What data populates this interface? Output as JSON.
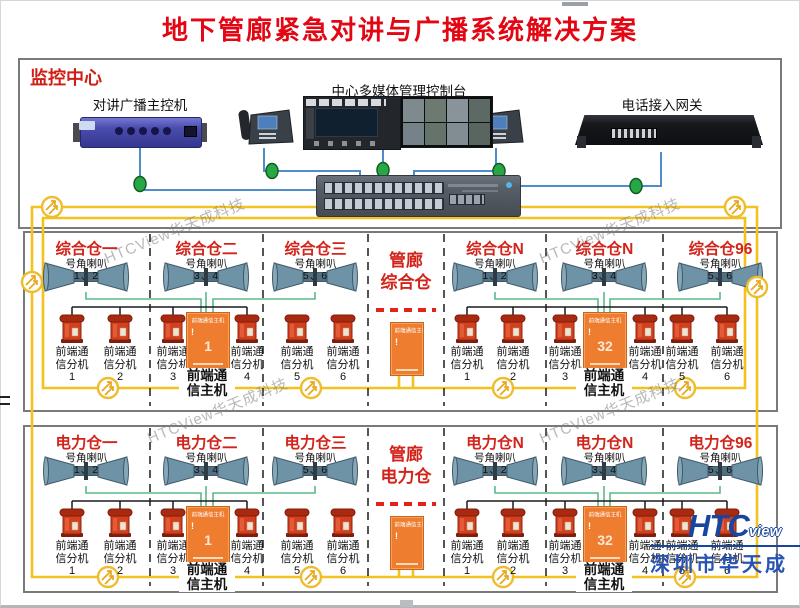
{
  "title": "地下管廊紧急对讲与广播系统解决方案",
  "monitoring": {
    "label": "监控中心",
    "main_controller": "对讲广播主控机",
    "console": "中心多媒体管理控制台",
    "gateway": "电话接入网关"
  },
  "shared": {
    "speaker_label": "号角喇叭",
    "phone_caption_l1": "前端通",
    "phone_caption_l2": "信分机",
    "host_caption_l1": "前端通",
    "host_caption_l2": "信主机",
    "host_tiny": "前端通信主机",
    "alert_mark": "!"
  },
  "sections": [
    {
      "compartments": [
        {
          "title": "综合仓一",
          "speakers": "1、2",
          "phones": [
            "1",
            "2"
          ]
        },
        {
          "title": "综合仓二",
          "speakers": "3、4",
          "phones": [
            "3",
            "4"
          ],
          "host_number": "1"
        },
        {
          "title": "综合仓三",
          "speakers": "5、6",
          "phones": [
            "5",
            "6"
          ]
        },
        {
          "title_line1": "管廊",
          "title_line2": "综合仓"
        },
        {
          "title": "综合仓N",
          "speakers": "1、2",
          "phones": [
            "1",
            "2"
          ]
        },
        {
          "title": "综合仓N",
          "speakers": "3、4",
          "phones": [
            "3",
            "4"
          ],
          "host_number": "32"
        },
        {
          "title": "综合仓96",
          "speakers": "5、6",
          "phones": [
            "5",
            "6"
          ]
        }
      ]
    },
    {
      "compartments": [
        {
          "title": "电力仓一",
          "speakers": "1、2",
          "phones": [
            "1",
            "2"
          ]
        },
        {
          "title": "电力仓二",
          "speakers": "3、4",
          "phones": [
            "3",
            "4"
          ],
          "host_number": "1"
        },
        {
          "title": "电力仓三",
          "speakers": "5、6",
          "phones": [
            "5",
            "6"
          ]
        },
        {
          "title_line1": "管廊",
          "title_line2": "电力仓"
        },
        {
          "title": "电力仓N",
          "speakers": "1、2",
          "phones": [
            "1",
            "2"
          ]
        },
        {
          "title": "电力仓N",
          "speakers": "3、4",
          "phones": [
            "3",
            "4"
          ],
          "host_number": "32"
        },
        {
          "title": "电力仓96",
          "speakers": "5、6",
          "phones": [
            "5",
            "6"
          ]
        }
      ]
    }
  ],
  "watermark": "HTCView华天成科技",
  "logo": {
    "brand": "HTC",
    "brand_suffix": "view",
    "company": "深圳市华天成"
  },
  "colors": {
    "title_red": "#e30613",
    "section_red": "#d2241a",
    "power_yellow": "#f3c21f",
    "host_orange": "#ee7d2f",
    "line_blue": "#4f8cc9",
    "line_green": "#5cb98a",
    "node_green": "#27a844",
    "phone_red": "#d2401e"
  }
}
